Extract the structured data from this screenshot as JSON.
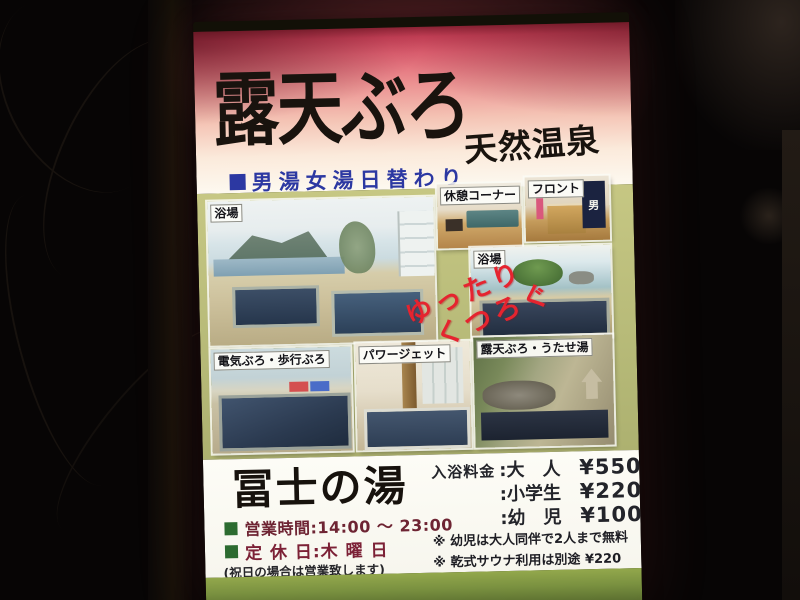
{
  "sign": {
    "title": "露天ぶろ",
    "subtitle": "天然温泉",
    "tagline": "男湯女湯日替わり",
    "handwriting": {
      "line1": "ゆったり",
      "line2": "くつろぐ"
    },
    "photos": [
      {
        "label": "浴場"
      },
      {
        "label": "休憩コーナー"
      },
      {
        "label": "フロント",
        "noren_text": "男"
      },
      {
        "label": "浴場"
      },
      {
        "label": "電気ぶろ・歩行ぶろ"
      },
      {
        "label": "パワージェット"
      },
      {
        "label": "露天ぶろ・うたせ湯"
      }
    ],
    "footer": {
      "name": "冨士の湯",
      "prices": {
        "rows": [
          {
            "label": "入浴料金",
            "category": ":大　人",
            "price": "¥550"
          },
          {
            "label": "",
            "category": ":小学生",
            "price": "¥220"
          },
          {
            "label": "",
            "category": ":幼　児",
            "price": "¥100"
          }
        ]
      },
      "hours": "営業時間:14:00 ～ 23:00",
      "closed": "定 休 日:木 曜 日",
      "holiday_note": "(祝日の場合は営業致します)",
      "notes": [
        "※ 幼児は大人同伴で2人まで無料",
        "※ 乾式サウナ利用は別途 ¥220"
      ]
    },
    "colors": {
      "top_gradient_red": "#d9485e",
      "tagline_blue": "#2c38a2",
      "mid_background_green": "#b9bc7a",
      "bullet_green": "#2c6b30",
      "closed_day_red": "#7c2136",
      "handwriting_red": "#e5242f",
      "bottom_strip_green": "#7a9140"
    }
  }
}
